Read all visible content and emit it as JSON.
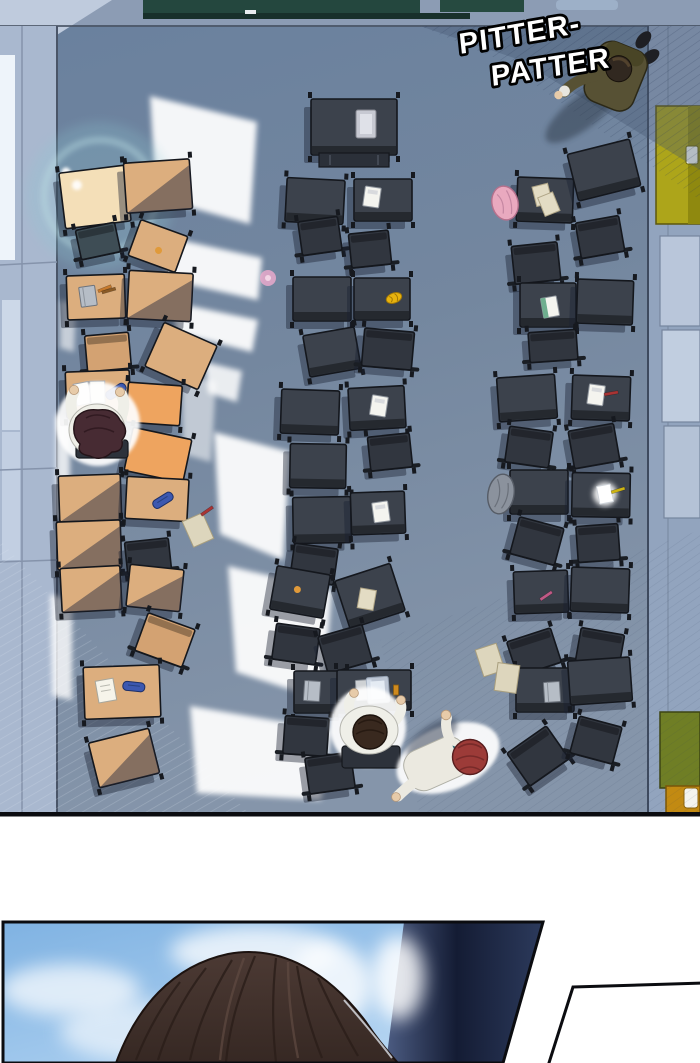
{
  "page": {
    "width": 700,
    "height": 1063,
    "background": "#ffffff",
    "type": "webtoon-comic-page"
  },
  "sfx": {
    "line1": "PITTER-",
    "line2": "PATTER"
  },
  "palette": {
    "floor": "#71859f",
    "floor_dark": "#5d7290",
    "floor_light": "#8a99af",
    "wall_left": "#a9b8cf",
    "wall_right": "#92a4be",
    "wall_top": "#8c9cb4",
    "chalkboard": "#24473e",
    "chalk_tray": "#18302b",
    "door_yellow": "#ada51a",
    "door_olive": "#6f7e25",
    "door_orange": "#c28a12",
    "desk_wood": "#dcae7e",
    "desk_wood_bright": "#eea45f",
    "desk_cream": "#f4dfb8",
    "desk_dark": "#3c424c",
    "chair_dark": "#31363f",
    "chair_wood": "#d3a272",
    "chair_teal": "#3e4d55",
    "sunlight": "#ffffff",
    "flare_teal": "#8ec8d2",
    "flare_pink": "#e9a9cb",
    "sky": "#8cb9e6",
    "pillar": "#1c2742",
    "speech_bubble": "#ffffff",
    "hair_reader": "#472b33",
    "hair_sitting": "#39291f",
    "hair_red": "#9c3b38",
    "hair_panel2": "#46352f",
    "jacket_olive": "#575134",
    "shirt_white": "#efefe8",
    "skin": "#e7cba9",
    "sfx_fill": "#ffffff",
    "sfx_outline": "#000000",
    "panel_border": "#0b0c10"
  },
  "panel1": {
    "name": "classroom-overhead-view",
    "bottom_border_y": 812,
    "desks": [
      {
        "x": 95,
        "y": 197,
        "w": 66,
        "h": 56,
        "r": -7,
        "f": "cream"
      },
      {
        "x": 158,
        "y": 186,
        "w": 66,
        "h": 50,
        "r": -4,
        "f": "tanShade"
      },
      {
        "x": 98,
        "y": 241,
        "w": 40,
        "h": 30,
        "r": -12,
        "f": "chairTeal"
      },
      {
        "x": 158,
        "y": 246,
        "w": 50,
        "h": 38,
        "r": 20,
        "f": "tan",
        "items": [
          {
            "t": "dotOrange",
            "x": 2,
            "y": 4
          }
        ]
      },
      {
        "x": 96,
        "y": 297,
        "w": 58,
        "h": 44,
        "r": -2,
        "f": "tan",
        "items": [
          {
            "t": "graynote",
            "x": -8,
            "y": -1,
            "r": -6
          },
          {
            "t": "pencil",
            "x": 9,
            "y": -8,
            "r": 70,
            "c": "#c67a2e"
          },
          {
            "t": "pencil",
            "x": 13,
            "y": -6,
            "r": 76,
            "c": "#8a5a26"
          }
        ]
      },
      {
        "x": 160,
        "y": 296,
        "w": 64,
        "h": 48,
        "r": 3,
        "f": "tanShade"
      },
      {
        "x": 108,
        "y": 352,
        "w": 44,
        "h": 36,
        "r": -5,
        "f": "chairTan"
      },
      {
        "x": 181,
        "y": 356,
        "w": 58,
        "h": 48,
        "r": 24,
        "f": "tan"
      },
      {
        "x": 98,
        "y": 394,
        "w": 64,
        "h": 46,
        "r": -2,
        "f": "tan",
        "items": [
          {
            "t": "book",
            "x": -8,
            "y": -2,
            "r": -4
          },
          {
            "t": "case",
            "x": 18,
            "y": -2,
            "r": -30
          }
        ]
      },
      {
        "x": 154,
        "y": 404,
        "w": 54,
        "h": 40,
        "r": 4,
        "f": "tanBright"
      },
      {
        "x": 158,
        "y": 455,
        "w": 60,
        "h": 44,
        "r": 12,
        "f": "tanBright"
      },
      {
        "x": 90,
        "y": 498,
        "w": 62,
        "h": 46,
        "r": -2,
        "f": "tanShade"
      },
      {
        "x": 157,
        "y": 499,
        "w": 62,
        "h": 42,
        "r": 3,
        "f": "tan",
        "items": [
          {
            "t": "case",
            "x": 6,
            "y": 1,
            "r": -35
          }
        ]
      },
      {
        "x": 89,
        "y": 545,
        "w": 64,
        "h": 48,
        "r": -2,
        "f": "tanShade"
      },
      {
        "x": 148,
        "y": 556,
        "w": 44,
        "h": 32,
        "r": -6,
        "f": "chairDark"
      },
      {
        "x": 91,
        "y": 589,
        "w": 60,
        "h": 44,
        "r": -3,
        "f": "tanShade"
      },
      {
        "x": 155,
        "y": 588,
        "w": 54,
        "h": 42,
        "r": 6,
        "f": "tanShade"
      },
      {
        "x": 165,
        "y": 640,
        "w": 50,
        "h": 40,
        "r": 20,
        "f": "chairTan"
      },
      {
        "x": 122,
        "y": 692,
        "w": 76,
        "h": 52,
        "r": -2,
        "f": "tan",
        "items": [
          {
            "t": "paper2",
            "x": -16,
            "y": -2,
            "r": -8
          },
          {
            "t": "case",
            "x": 12,
            "y": -5,
            "r": 8
          }
        ]
      },
      {
        "x": 124,
        "y": 758,
        "w": 62,
        "h": 46,
        "r": -14,
        "f": "tanShade"
      },
      {
        "x": 354,
        "y": 127,
        "w": 86,
        "h": 56,
        "r": 0,
        "f": "dark",
        "items": [
          {
            "t": "podium",
            "x": 0,
            "y": 0
          },
          {
            "t": "graypanel",
            "x": 12,
            "y": -3,
            "r": 0
          }
        ]
      },
      {
        "x": 315,
        "y": 201,
        "w": 58,
        "h": 44,
        "r": 3,
        "f": "dark"
      },
      {
        "x": 383,
        "y": 200,
        "w": 58,
        "h": 42,
        "r": 0,
        "f": "dark",
        "items": [
          {
            "t": "note",
            "x": -11,
            "y": -3,
            "r": 8
          }
        ]
      },
      {
        "x": 320,
        "y": 236,
        "w": 40,
        "h": 34,
        "r": -8,
        "f": "chairDark"
      },
      {
        "x": 370,
        "y": 249,
        "w": 40,
        "h": 34,
        "r": -6,
        "f": "chairDark"
      },
      {
        "x": 322,
        "y": 299,
        "w": 58,
        "h": 44,
        "r": 0,
        "f": "dark"
      },
      {
        "x": 382,
        "y": 299,
        "w": 56,
        "h": 42,
        "r": 0,
        "f": "dark",
        "items": [
          {
            "t": "food",
            "x": 12,
            "y": -1,
            "r": -20
          }
        ]
      },
      {
        "x": 332,
        "y": 352,
        "w": 52,
        "h": 42,
        "r": -10,
        "f": "dark"
      },
      {
        "x": 388,
        "y": 349,
        "w": 50,
        "h": 38,
        "r": 5,
        "f": "chairDark"
      },
      {
        "x": 310,
        "y": 412,
        "w": 58,
        "h": 44,
        "r": 2,
        "f": "dark"
      },
      {
        "x": 377,
        "y": 408,
        "w": 56,
        "h": 42,
        "r": -3,
        "f": "dark",
        "items": [
          {
            "t": "note",
            "x": 2,
            "y": -2,
            "r": 12
          }
        ]
      },
      {
        "x": 390,
        "y": 452,
        "w": 42,
        "h": 34,
        "r": -6,
        "f": "chairDark"
      },
      {
        "x": 318,
        "y": 466,
        "w": 56,
        "h": 44,
        "r": 1,
        "f": "dark"
      },
      {
        "x": 322,
        "y": 520,
        "w": 58,
        "h": 46,
        "r": -1,
        "f": "dark"
      },
      {
        "x": 378,
        "y": 513,
        "w": 54,
        "h": 42,
        "r": -2,
        "f": "dark",
        "items": [
          {
            "t": "note",
            "x": 3,
            "y": -1,
            "r": -6
          }
        ]
      },
      {
        "x": 314,
        "y": 564,
        "w": 44,
        "h": 36,
        "r": 8,
        "f": "chairDark"
      },
      {
        "x": 300,
        "y": 592,
        "w": 54,
        "h": 44,
        "r": 10,
        "f": "dark",
        "items": [
          {
            "t": "dotOrange",
            "x": -3,
            "y": -2
          }
        ]
      },
      {
        "x": 370,
        "y": 596,
        "w": 58,
        "h": 50,
        "r": -18,
        "f": "dark",
        "items": [
          {
            "t": "paper",
            "x": -4,
            "y": 2,
            "r": 28
          }
        ]
      },
      {
        "x": 296,
        "y": 644,
        "w": 44,
        "h": 36,
        "r": 8,
        "f": "chairDark"
      },
      {
        "x": 345,
        "y": 649,
        "w": 46,
        "h": 38,
        "r": -16,
        "f": "chairDark"
      },
      {
        "x": 320,
        "y": 692,
        "w": 52,
        "h": 42,
        "r": 0,
        "f": "dark",
        "items": [
          {
            "t": "graynote",
            "x": -8,
            "y": -1,
            "r": 4
          }
        ]
      },
      {
        "x": 374,
        "y": 690,
        "w": 74,
        "h": 40,
        "r": 0,
        "f": "dark",
        "items": [
          {
            "t": "notefaint",
            "x": -10,
            "y": 0,
            "r": -4
          },
          {
            "t": "glasspanel",
            "x": 4,
            "y": 0,
            "r": -4
          },
          {
            "t": "tag",
            "x": 22,
            "y": 0,
            "r": 0
          }
        ]
      },
      {
        "x": 306,
        "y": 736,
        "w": 44,
        "h": 38,
        "r": 4,
        "f": "chairDark"
      },
      {
        "x": 330,
        "y": 773,
        "w": 46,
        "h": 36,
        "r": -8,
        "f": "chairDark"
      },
      {
        "x": 545,
        "y": 200,
        "w": 56,
        "h": 44,
        "r": 2,
        "f": "dark",
        "items": [
          {
            "t": "paper",
            "x": -3,
            "y": -5,
            "r": -16
          },
          {
            "t": "paper",
            "x": 4,
            "y": 4,
            "r": -24
          }
        ]
      },
      {
        "x": 604,
        "y": 170,
        "w": 64,
        "h": 48,
        "r": -14,
        "f": "dark"
      },
      {
        "x": 600,
        "y": 237,
        "w": 44,
        "h": 36,
        "r": -10,
        "f": "chairDark"
      },
      {
        "x": 536,
        "y": 263,
        "w": 46,
        "h": 38,
        "r": -6,
        "f": "chairDark"
      },
      {
        "x": 548,
        "y": 305,
        "w": 56,
        "h": 44,
        "r": 0,
        "f": "dark",
        "items": [
          {
            "t": "noteG",
            "x": 2,
            "y": 2,
            "r": -10
          }
        ]
      },
      {
        "x": 605,
        "y": 302,
        "w": 56,
        "h": 44,
        "r": 2,
        "f": "dark"
      },
      {
        "x": 553,
        "y": 346,
        "w": 48,
        "h": 30,
        "r": -4,
        "f": "chairDark"
      },
      {
        "x": 527,
        "y": 398,
        "w": 58,
        "h": 44,
        "r": -4,
        "f": "dark"
      },
      {
        "x": 601,
        "y": 398,
        "w": 58,
        "h": 44,
        "r": 2,
        "f": "dark",
        "items": [
          {
            "t": "note",
            "x": -5,
            "y": -3,
            "r": 6
          },
          {
            "t": "pencil",
            "x": 10,
            "y": -5,
            "r": 78,
            "c": "#a83434"
          }
        ]
      },
      {
        "x": 529,
        "y": 447,
        "w": 44,
        "h": 36,
        "r": 8,
        "f": "chairDark"
      },
      {
        "x": 594,
        "y": 446,
        "w": 46,
        "h": 38,
        "r": -10,
        "f": "chairDark"
      },
      {
        "x": 539,
        "y": 492,
        "w": 58,
        "h": 44,
        "r": 0,
        "f": "dark"
      },
      {
        "x": 601,
        "y": 495,
        "w": 58,
        "h": 44,
        "r": 1,
        "f": "dark",
        "items": [
          {
            "t": "glow",
            "x": 4,
            "y": -1,
            "r": -12
          },
          {
            "t": "pencil",
            "x": 17,
            "y": -5,
            "r": 72,
            "c": "#cdb414"
          }
        ]
      },
      {
        "x": 537,
        "y": 541,
        "w": 46,
        "h": 38,
        "r": 15,
        "f": "chairDark"
      },
      {
        "x": 598,
        "y": 543,
        "w": 42,
        "h": 36,
        "r": -4,
        "f": "chairDark"
      },
      {
        "x": 541,
        "y": 592,
        "w": 54,
        "h": 42,
        "r": -2,
        "f": "dark",
        "items": [
          {
            "t": "pencil",
            "x": 5,
            "y": 4,
            "r": 58,
            "c": "#c05a86"
          }
        ]
      },
      {
        "x": 600,
        "y": 590,
        "w": 58,
        "h": 44,
        "r": 2,
        "f": "dark"
      },
      {
        "x": 534,
        "y": 652,
        "w": 46,
        "h": 36,
        "r": -18,
        "f": "chairDark"
      },
      {
        "x": 600,
        "y": 648,
        "w": 44,
        "h": 34,
        "r": 10,
        "f": "chairDark"
      },
      {
        "x": 545,
        "y": 690,
        "w": 58,
        "h": 44,
        "r": 0,
        "f": "dark",
        "items": [
          {
            "t": "graynote",
            "x": 7,
            "y": 2,
            "r": -4
          }
        ]
      },
      {
        "x": 600,
        "y": 681,
        "w": 62,
        "h": 44,
        "r": -4,
        "f": "dark"
      },
      {
        "x": 538,
        "y": 756,
        "w": 48,
        "h": 40,
        "r": -35,
        "f": "chairDark"
      },
      {
        "x": 596,
        "y": 740,
        "w": 44,
        "h": 38,
        "r": 15,
        "f": "chairDark"
      }
    ],
    "floor_items": [
      {
        "t": "bagPink",
        "x": 505,
        "y": 203,
        "r": -12
      },
      {
        "t": "bagGray",
        "x": 501,
        "y": 494,
        "r": 10
      },
      {
        "t": "paperF",
        "x": 490,
        "y": 660,
        "r": -18
      },
      {
        "t": "paperF",
        "x": 507,
        "y": 678,
        "r": 8
      },
      {
        "t": "paperF",
        "x": 198,
        "y": 530,
        "r": -24
      },
      {
        "t": "pencilF",
        "x": 207,
        "y": 511,
        "r": 55,
        "c": "#a83434"
      }
    ],
    "lights": [
      {
        "pts": "150,96 257,122 250,224 156,198"
      },
      {
        "pts": "162,236 262,258 258,300 168,280"
      },
      {
        "pts": "171,302 258,320 252,352 177,333"
      },
      {
        "pts": "205,362 242,371 237,402 208,393",
        "op": 0.85
      },
      {
        "pts": "214,432 290,452 283,560 220,534"
      },
      {
        "pts": "228,566 332,590 323,700 236,672"
      },
      {
        "pts": "190,706 332,730 321,800 197,793"
      },
      {
        "pts": "56,414 70,418 70,522 56,518",
        "op": 0.8
      },
      {
        "pts": "50,594 72,600 72,700 52,696",
        "op": 0.8
      },
      {
        "pts": "60,300 76,304 74,352 60,348",
        "op": 0.6
      },
      {
        "pts": "182,374 216,382 211,462 183,454",
        "op": 0.55
      }
    ],
    "people": [
      {
        "id": "walking-student-top-right"
      },
      {
        "id": "reading-student-left"
      },
      {
        "id": "sitting-student-bottom"
      },
      {
        "id": "red-haired-student-bottom"
      }
    ]
  },
  "panel2": {
    "name": "closeup-back-of-head",
    "border": "3,922 543,922 503,1063 3,1063",
    "speech_bubble_text": ""
  }
}
